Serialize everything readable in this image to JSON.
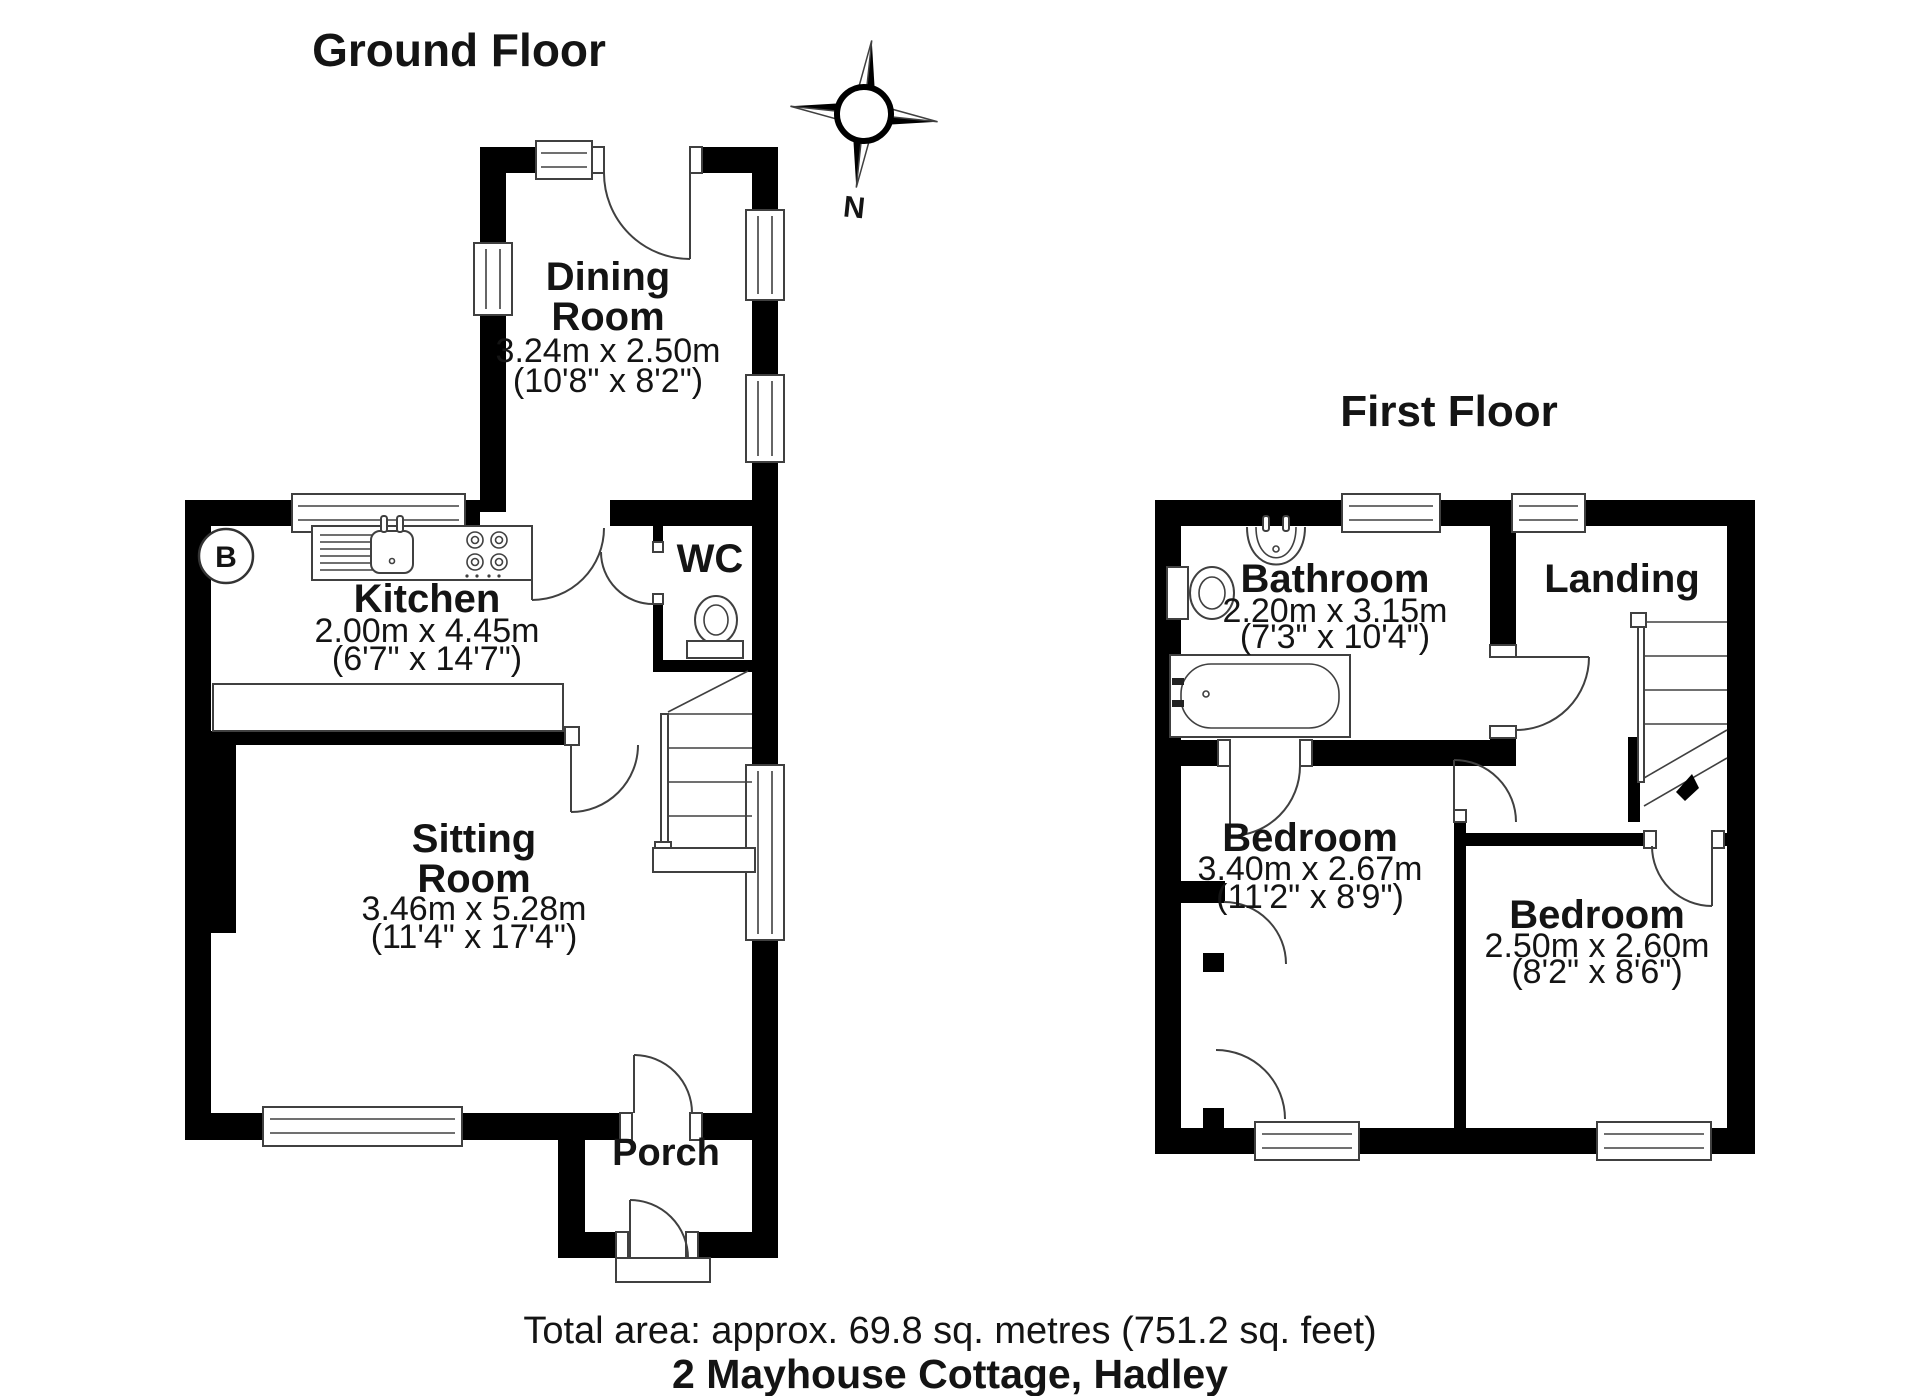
{
  "titles": {
    "ground_floor": "Ground Floor",
    "first_floor": "First Floor"
  },
  "compass": {
    "north": "N"
  },
  "ground_floor": {
    "dining_room": {
      "name_line1": "Dining",
      "name_line2": "Room",
      "metric": "3.24m x 2.50m",
      "imperial": "(10'8\" x 8'2\")"
    },
    "kitchen": {
      "name": "Kitchen",
      "metric": "2.00m x 4.45m",
      "imperial": "(6'7\" x 14'7\")"
    },
    "wc": {
      "name": "WC"
    },
    "sitting_room": {
      "name_line1": "Sitting",
      "name_line2": "Room",
      "metric": "3.46m x 5.28m",
      "imperial": "(11'4\" x 17'4\")"
    },
    "porch": {
      "name": "Porch"
    },
    "boiler": "B"
  },
  "first_floor": {
    "bathroom": {
      "name": "Bathroom",
      "metric": "2.20m x 3.15m",
      "imperial": "(7'3\" x 10'4\")"
    },
    "landing": {
      "name": "Landing"
    },
    "bedroom_left": {
      "name": "Bedroom",
      "metric": "3.40m x 2.67m",
      "imperial": "(11'2\" x 8'9\")"
    },
    "bedroom_right": {
      "name": "Bedroom",
      "metric": "2.50m x 2.60m",
      "imperial": "(8'2\" x 8'6\")"
    }
  },
  "footer": {
    "total_area": "Total area: approx. 69.8 sq. metres (751.2 sq. feet)",
    "address": "2 Mayhouse Cottage, Hadley"
  },
  "colors": {
    "wall": "#000000",
    "line": "#404040",
    "text": "#141414",
    "background": "#ffffff"
  }
}
